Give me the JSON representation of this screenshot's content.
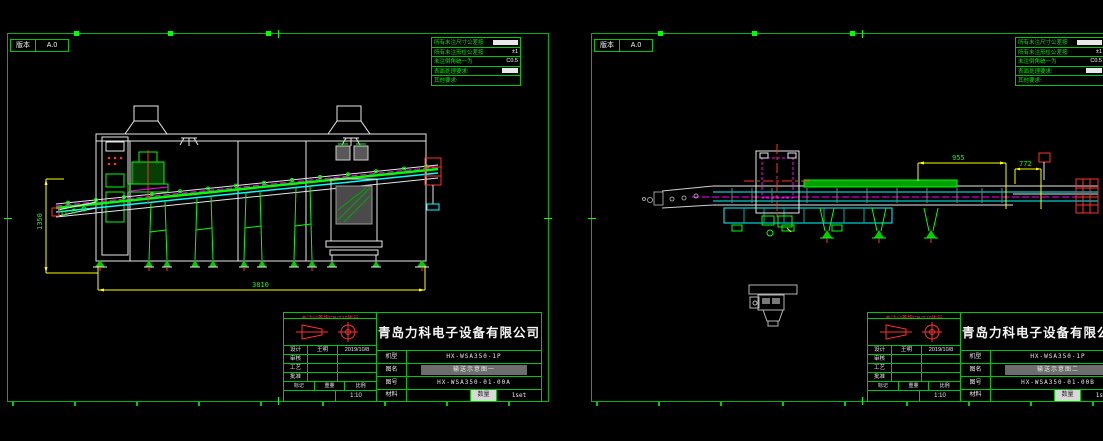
{
  "colors": {
    "background": "#000000",
    "sheet_border_green": "#00b400",
    "line_green": "#00ff00",
    "dim_yellow": "#ffff00",
    "conveyor_cyan": "#00ffff",
    "centerline_magenta": "#ff00ff",
    "accent_red": "#ff3030",
    "line_white": "#e8e8e8"
  },
  "sheets": [
    {
      "version": {
        "label": "版本",
        "value": "A.0"
      },
      "notes": [
        {
          "label": "所有未注尺寸公差按",
          "value": "GB/T1804"
        },
        {
          "label": "所有未注形位公差按",
          "value": "±1"
        },
        {
          "label": "未注倒角统一为",
          "value": "C0.5"
        },
        {
          "label": "表面处理要求:",
          "value": "喷塑"
        },
        {
          "label": "其他要求:",
          "value": ""
        }
      ],
      "dims": {
        "height": "1350",
        "length": "3810"
      },
      "title_block": {
        "tolerance_note": "未注公差按GB/T19执行",
        "company": "青岛力科电子设备有限公司",
        "sign_rows": [
          {
            "label": "设计",
            "name": "王明",
            "date": "2019/10/8"
          },
          {
            "label": "审核",
            "name": "",
            "date": ""
          },
          {
            "label": "工艺",
            "name": "",
            "date": ""
          },
          {
            "label": "批准",
            "name": "",
            "date": ""
          }
        ],
        "mark_cells": [
          "标记",
          "重量",
          "比例"
        ],
        "scale": "1:10",
        "fields": [
          {
            "label": "机型",
            "value": "HX-WSA350-1P"
          },
          {
            "label": "图名",
            "value": "输送示意图一"
          },
          {
            "label": "图号",
            "value": "HX-WSA350-01-00A"
          }
        ],
        "material_label": "材料",
        "material_value": "",
        "qty_label": "数量",
        "qty_value": "1set"
      }
    },
    {
      "version": {
        "label": "版本",
        "value": "A.0"
      },
      "notes": [
        {
          "label": "所有未注尺寸公差按",
          "value": "GB/T1804"
        },
        {
          "label": "所有未注形位公差按",
          "value": "±1"
        },
        {
          "label": "未注倒角统一为",
          "value": "C0.5"
        },
        {
          "label": "表面处理要求:",
          "value": "喷塑"
        },
        {
          "label": "其他要求:",
          "value": ""
        }
      ],
      "dims": {
        "a": "955",
        "b": "772"
      },
      "title_block": {
        "tolerance_note": "未注公差按GB/T19执行",
        "company": "青岛力科电子设备有限公司",
        "sign_rows": [
          {
            "label": "设计",
            "name": "王明",
            "date": "2019/10/8"
          },
          {
            "label": "审核",
            "name": "",
            "date": ""
          },
          {
            "label": "工艺",
            "name": "",
            "date": ""
          },
          {
            "label": "批准",
            "name": "",
            "date": ""
          }
        ],
        "mark_cells": [
          "标记",
          "重量",
          "比例"
        ],
        "scale": "1:10",
        "fields": [
          {
            "label": "机型",
            "value": "HX-WSA350-1P"
          },
          {
            "label": "图名",
            "value": "输送示意图二"
          },
          {
            "label": "图号",
            "value": "HX-WSA350-01-00B"
          }
        ],
        "material_label": "材料",
        "material_value": "",
        "qty_label": "数量",
        "qty_value": "1set"
      }
    }
  ]
}
